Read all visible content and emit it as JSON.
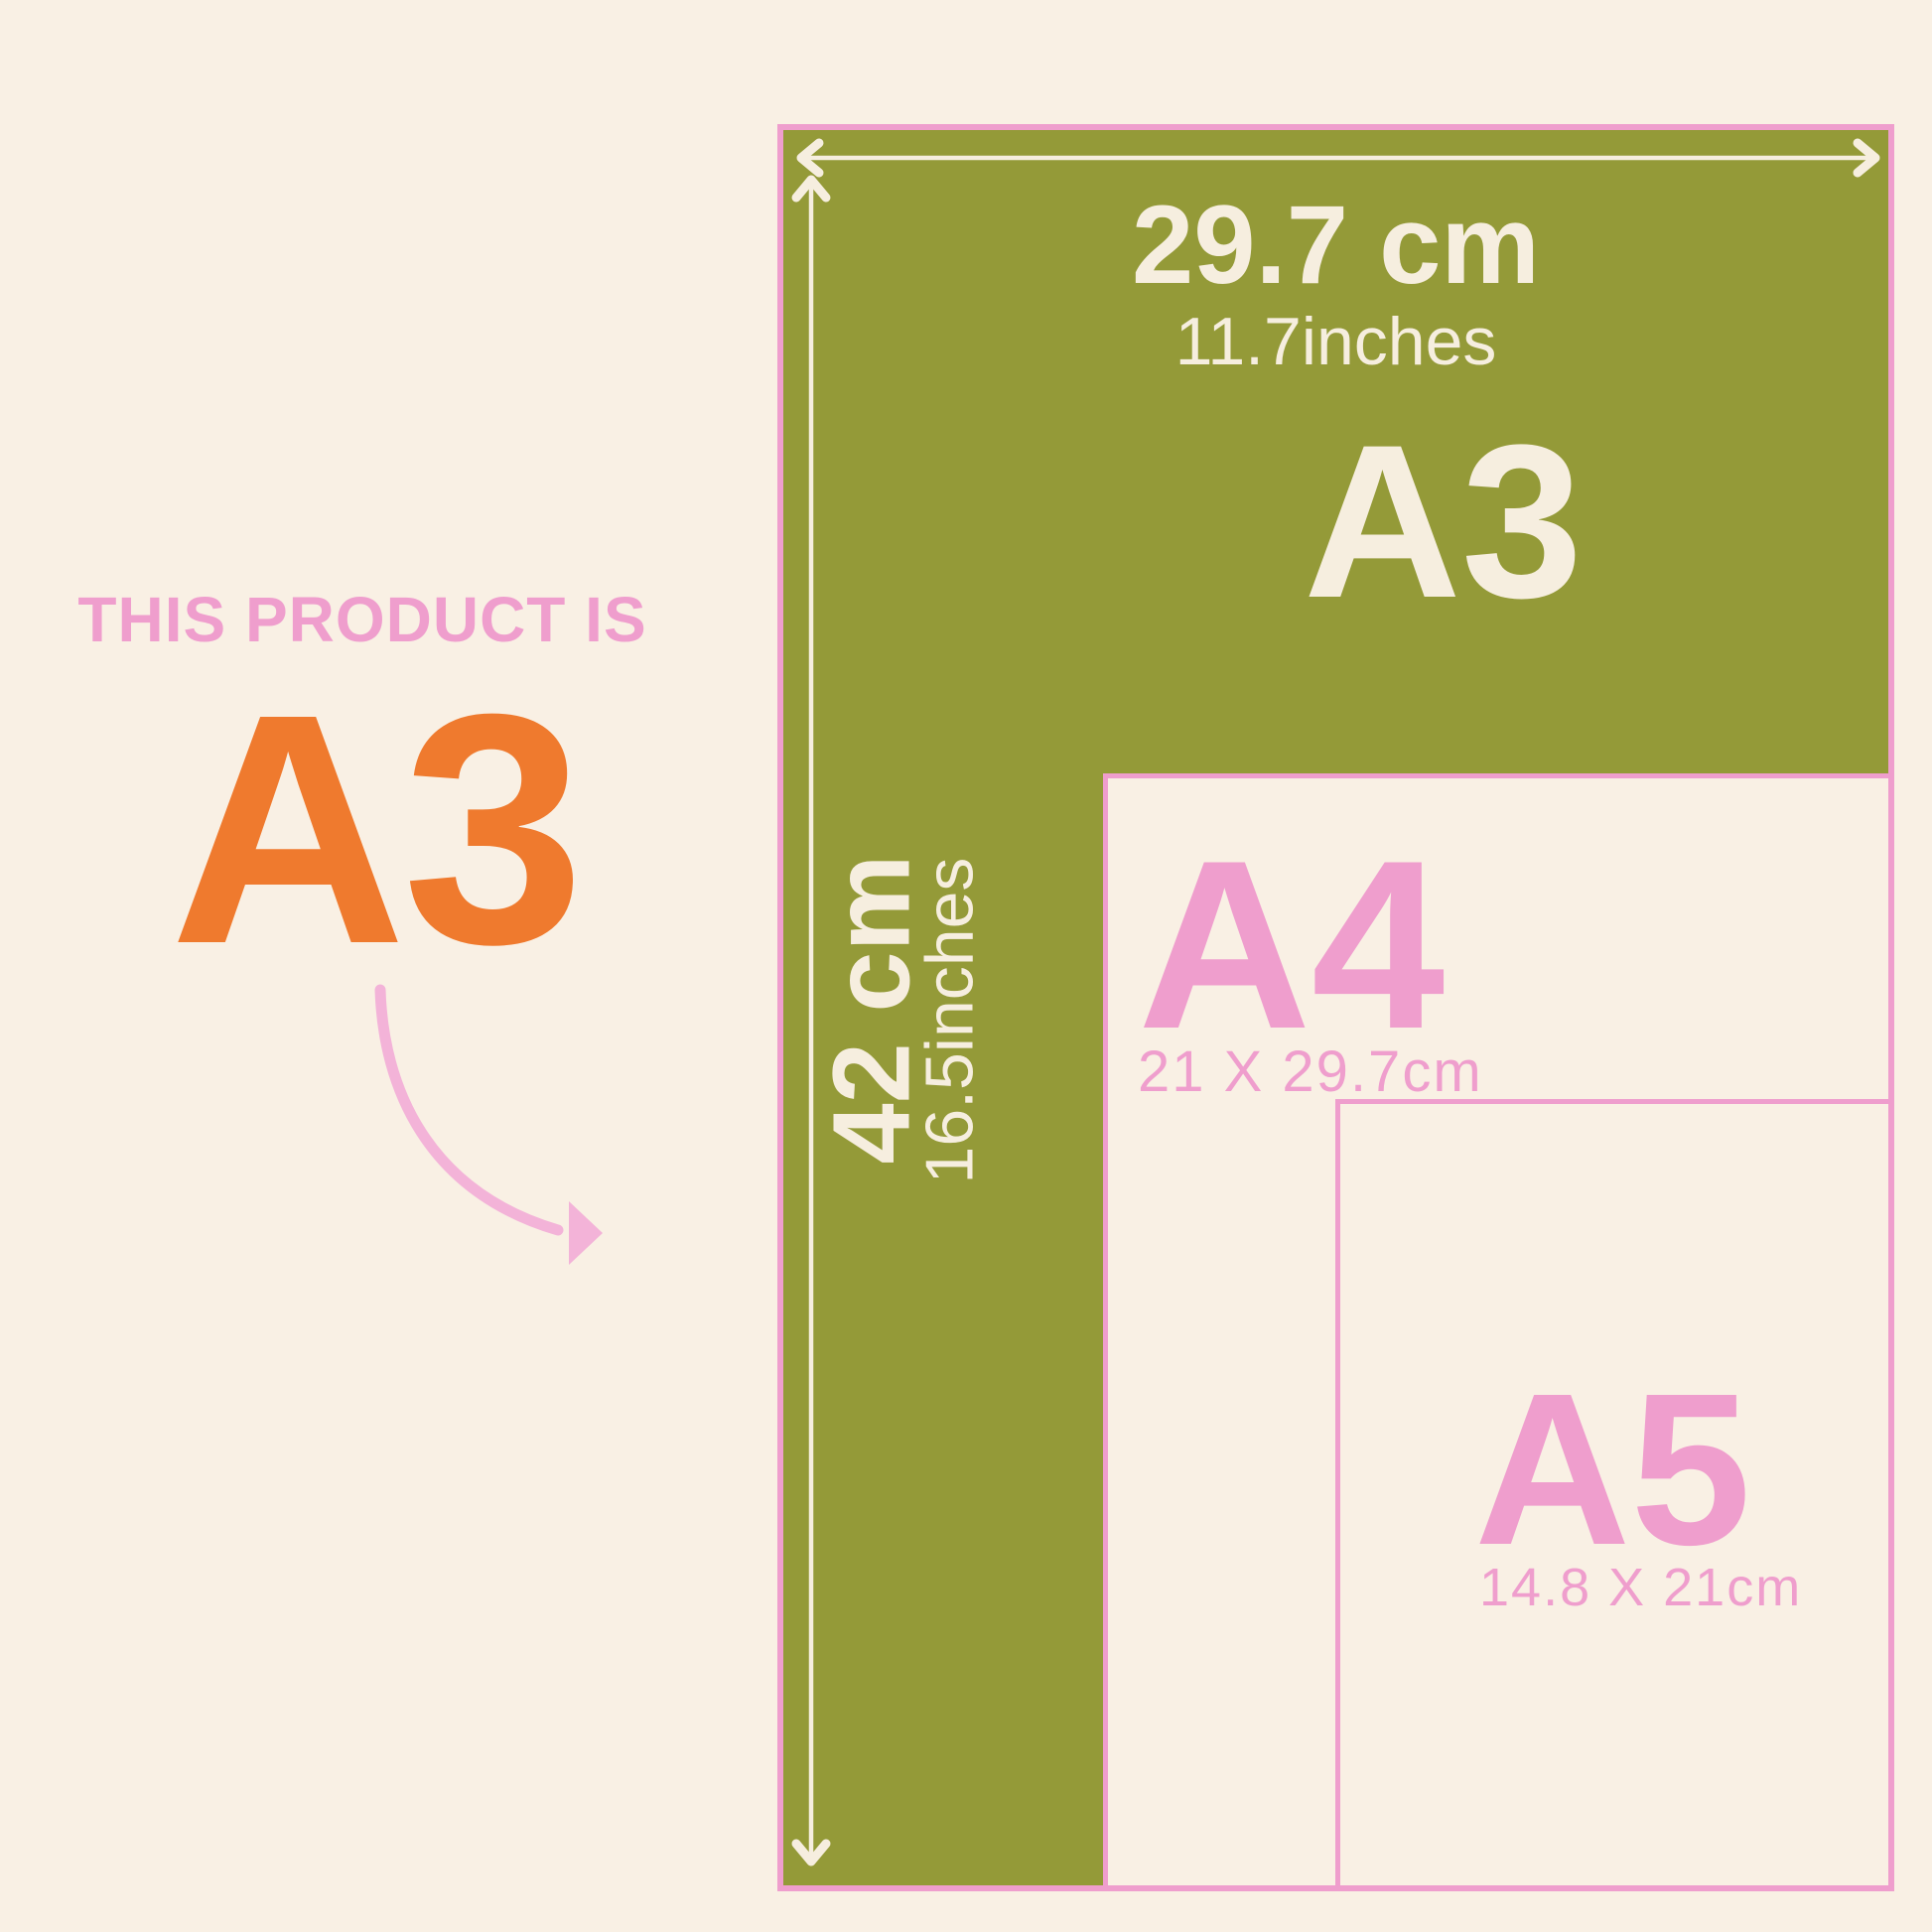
{
  "title": "Paper size guide infographic",
  "colors": {
    "background": "#F9F0E4",
    "olive_green": "#949A38",
    "pink": "#EF9ECD",
    "pink_soft": "#F3B3D8",
    "orange": "#EF7A2E",
    "cream_text": "#F6EEDF"
  },
  "left_panel": {
    "eyebrow": "THIS PRODUCT IS",
    "size_label": "A3",
    "pointer_icon": "curved-arrow-icon"
  },
  "diagram": {
    "a3": {
      "label": "A3",
      "width_cm": "29.7 cm",
      "width_inches": "11.7inches",
      "height_cm": "42 cm",
      "height_inches": "16.5inches",
      "width_arrow_icon": "double-headed-horizontal-arrow-icon",
      "height_arrow_icon": "double-headed-vertical-arrow-icon"
    },
    "a4": {
      "label": "A4",
      "dimensions": "21 X 29.7cm"
    },
    "a5": {
      "label": "A5",
      "dimensions": "14.8 X 21cm"
    }
  }
}
